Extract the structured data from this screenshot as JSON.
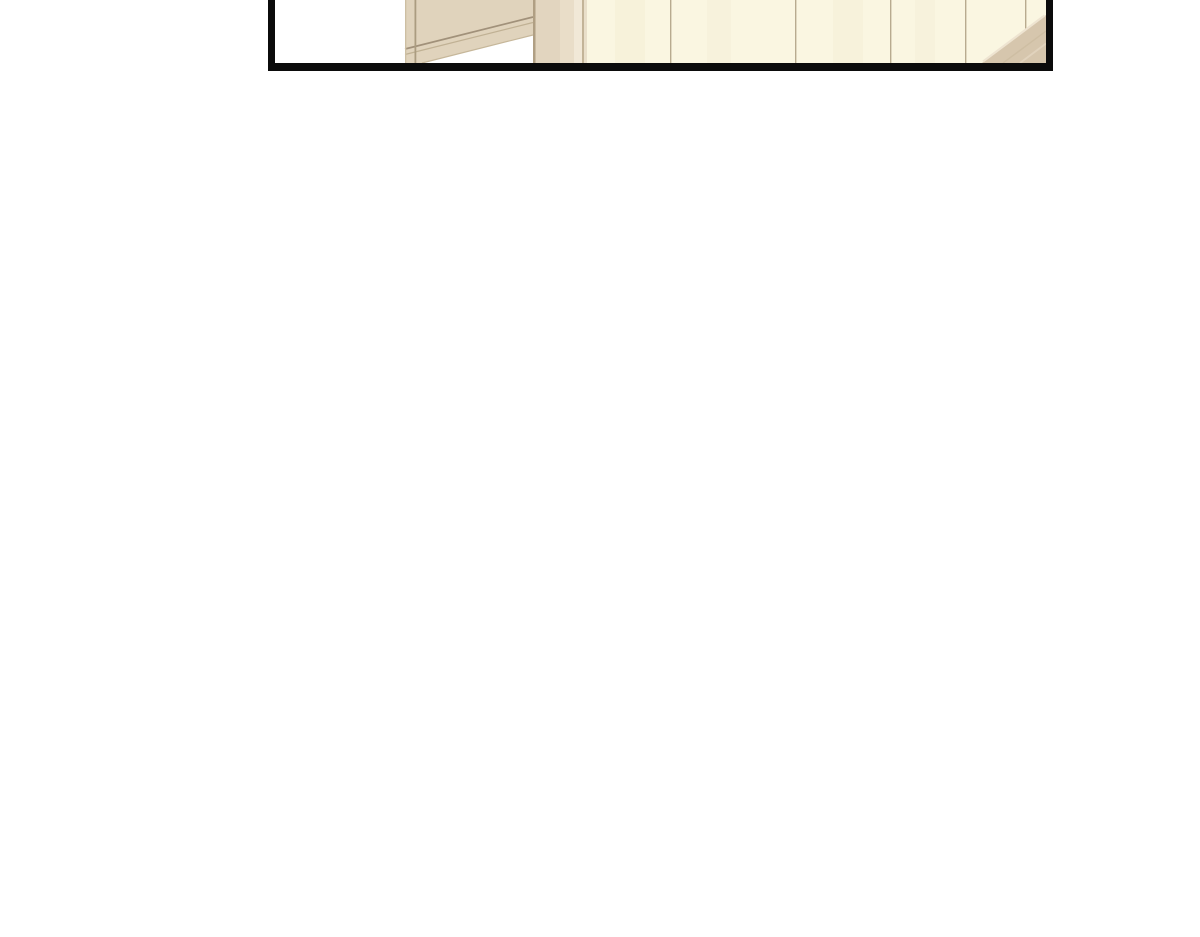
{
  "scene": {
    "description": "Bottom sliver of a tall webtoon comic panel, cut off by the top of the viewport, showing a room interior: white wall at left, an open door edge with beige door-frame post, cream wardrobe door panels with vertical seams, and a tan floor/furniture corner at bottom right. Rest of the page is blank white."
  },
  "panel": {
    "colors": {
      "border_black": "#0b0b0b",
      "interior_white": "#ffffff",
      "door_face": "#e0d3bc",
      "door_edge_line": "#a1917a",
      "door_edge_line_soft": "#c0b194",
      "door_bottom_edge": "#c6b79a",
      "rail_edge_left": "#cdbfa3",
      "rail_edge_right": "#ab9c80",
      "post_base": "#e2d5bf",
      "post_shadow_left": "#b09f83",
      "post_mid_light": "#e9ddc8",
      "post_highlight": "#f1e8d7",
      "post_dark_line": "#c3b498",
      "post_right_sliver": "#e9dfca",
      "wall_cream": "#faf6e1",
      "wall_streak": "#f3eed4",
      "wall_seam": "#ac9d80",
      "floor_tan": "#d6c6ad",
      "floor_edge_highlight": "#eee4d1",
      "floor_streak_dark": "#cbba9e",
      "floor_streak_light": "#e3d6c0"
    }
  }
}
